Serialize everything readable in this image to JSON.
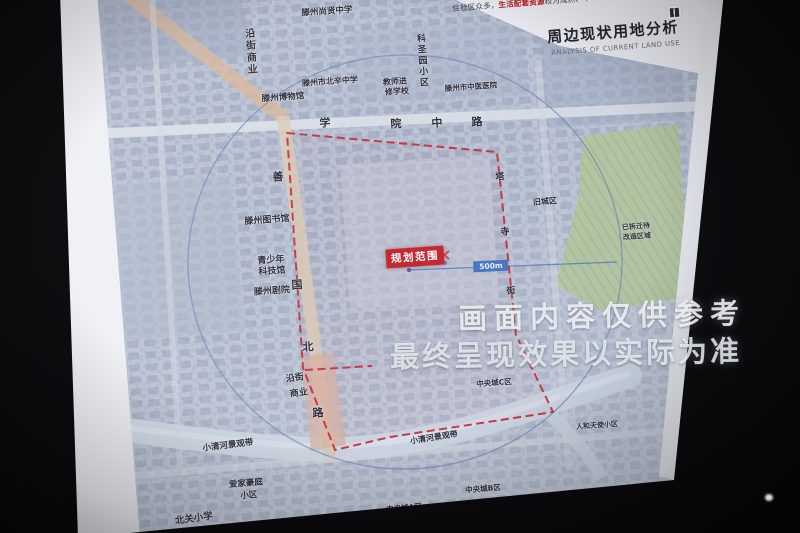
{
  "photo": {
    "watermark_line1": "画面内容仅供参考",
    "watermark_line2": "最终呈现效果以实际为准"
  },
  "slide": {
    "title_cn": "周边现状用地分析",
    "title_en": "ANALYSIS OF CURRENT LAND USE",
    "intro_prefix": "住社区众多，",
    "intro_highlight": "生活配套资源",
    "intro_suffix": "较为成熟、丰"
  },
  "map": {
    "planning_label": "规划范围",
    "radius_label": "500m",
    "colors": {
      "boundary_red": "#c5202b",
      "planning_box_red": "#c01a22",
      "radius_blue": "#3f6fbe",
      "circle_blue": "#5d79b5",
      "highlight_red": "#b51d22",
      "green_area": "#b3c79c"
    },
    "labels": [
      {
        "name": "label-street-commerce-north",
        "text": "沿街商业",
        "x": 249,
        "y": 52,
        "rot": -4,
        "size": 10,
        "vertical": true
      },
      {
        "name": "label-shangxian-middle-school",
        "text": "滕州尚贤中学",
        "x": 327,
        "y": 12,
        "rot": -4,
        "size": 8.5
      },
      {
        "name": "label-keshengyuan-community",
        "text": "科圣园小区",
        "x": 421,
        "y": 61,
        "rot": -4,
        "size": 9,
        "vertical": true
      },
      {
        "name": "label-beixin-middle-school",
        "text": "滕州市北辛中学",
        "x": 330,
        "y": 82,
        "rot": -4,
        "size": 8
      },
      {
        "name": "label-teachers-college-line1",
        "text": "教师进",
        "x": 395,
        "y": 82,
        "rot": -4,
        "size": 8
      },
      {
        "name": "label-teachers-college-line2",
        "text": "修学校",
        "x": 397,
        "y": 92,
        "rot": -4,
        "size": 8
      },
      {
        "name": "label-tcm-hospital",
        "text": "滕州市中医医院",
        "x": 471,
        "y": 87,
        "rot": -4,
        "size": 7.5
      },
      {
        "name": "label-museum",
        "text": "滕州博物馆",
        "x": 283,
        "y": 98,
        "rot": -4,
        "size": 8.5
      },
      {
        "name": "label-xueyuan-road-char-1",
        "text": "学",
        "x": 325,
        "y": 123,
        "rot": -4,
        "size": 11,
        "bold": true
      },
      {
        "name": "label-xueyuan-road-char-2",
        "text": "院",
        "x": 396,
        "y": 124,
        "rot": -4,
        "size": 11,
        "bold": true
      },
      {
        "name": "label-xueyuan-road-char-3",
        "text": "中",
        "x": 437,
        "y": 123,
        "rot": -4,
        "size": 11,
        "bold": true
      },
      {
        "name": "label-xueyuan-road-char-4",
        "text": "路",
        "x": 477,
        "y": 122,
        "rot": -4,
        "size": 11,
        "bold": true
      },
      {
        "name": "label-old-town",
        "text": "旧城区",
        "x": 545,
        "y": 202,
        "rot": -4,
        "size": 8
      },
      {
        "name": "label-library",
        "text": "滕州图书馆",
        "x": 267,
        "y": 221,
        "rot": -4,
        "size": 9
      },
      {
        "name": "label-youth-science-line1",
        "text": "青少年",
        "x": 271,
        "y": 261,
        "rot": -4,
        "size": 9
      },
      {
        "name": "label-youth-science-line2",
        "text": "科技馆",
        "x": 272,
        "y": 272,
        "rot": -4,
        "size": 9
      },
      {
        "name": "label-theater",
        "text": "滕州剧院",
        "x": 272,
        "y": 292,
        "rot": -4,
        "size": 9
      },
      {
        "name": "label-shanguo-road-char-1",
        "text": "善",
        "x": 278,
        "y": 177,
        "rot": -4,
        "size": 11,
        "bold": true
      },
      {
        "name": "label-shanguo-road-char-2",
        "text": "国",
        "x": 297,
        "y": 285,
        "rot": -4,
        "size": 11,
        "bold": true
      },
      {
        "name": "label-shanguo-road-char-3",
        "text": "北",
        "x": 308,
        "y": 347,
        "rot": -4,
        "size": 11,
        "bold": true
      },
      {
        "name": "label-shanguo-road-char-4",
        "text": "路",
        "x": 318,
        "y": 413,
        "rot": -4,
        "size": 11,
        "bold": true
      },
      {
        "name": "label-east-road-char-1",
        "text": "塔",
        "x": 500,
        "y": 178,
        "rot": -4,
        "size": 9,
        "bold": true
      },
      {
        "name": "label-east-road-char-2",
        "text": "寺",
        "x": 505,
        "y": 233,
        "rot": -4,
        "size": 9,
        "bold": true
      },
      {
        "name": "label-east-road-char-3",
        "text": "街",
        "x": 511,
        "y": 292,
        "rot": -4,
        "size": 9,
        "bold": true
      },
      {
        "name": "label-redevelopment-line1",
        "text": "已拆迁待",
        "x": 636,
        "y": 227,
        "rot": -4,
        "size": 7
      },
      {
        "name": "label-redevelopment-line2",
        "text": "改造区域",
        "x": 637,
        "y": 237,
        "rot": -4,
        "size": 7
      },
      {
        "name": "label-street-commerce-south-line1",
        "text": "沿街",
        "x": 295,
        "y": 379,
        "rot": -8,
        "size": 9
      },
      {
        "name": "label-street-commerce-south-line2",
        "text": "商业",
        "x": 299,
        "y": 394,
        "rot": -8,
        "size": 9
      },
      {
        "name": "label-xiaoqinghe-west",
        "text": "小清河景观带",
        "x": 228,
        "y": 446,
        "rot": -7,
        "size": 8.5
      },
      {
        "name": "label-xiaoqinghe-mid",
        "text": "小清河景观带",
        "x": 434,
        "y": 438,
        "rot": -9,
        "size": 8
      },
      {
        "name": "label-central-city-c",
        "text": "中央城C区",
        "x": 494,
        "y": 383,
        "rot": -4,
        "size": 7.5
      },
      {
        "name": "label-renhe-community",
        "text": "人和天使小区",
        "x": 597,
        "y": 426,
        "rot": -4,
        "size": 7
      },
      {
        "name": "label-aijia-community-line1",
        "text": "爱家豪庭",
        "x": 246,
        "y": 484,
        "rot": -5,
        "size": 8.5
      },
      {
        "name": "label-aijia-community-line2",
        "text": "小区",
        "x": 249,
        "y": 496,
        "rot": -5,
        "size": 8.5
      },
      {
        "name": "label-beiguan-primary",
        "text": "北关小学",
        "x": 194,
        "y": 519,
        "rot": -8,
        "size": 9.5
      },
      {
        "name": "label-central-city-a",
        "text": "中央城A区",
        "x": 404,
        "y": 508,
        "rot": -5,
        "size": 7.5
      },
      {
        "name": "label-central-city-b",
        "text": "中央城B区",
        "x": 483,
        "y": 489,
        "rot": -5,
        "size": 7.5
      }
    ]
  }
}
